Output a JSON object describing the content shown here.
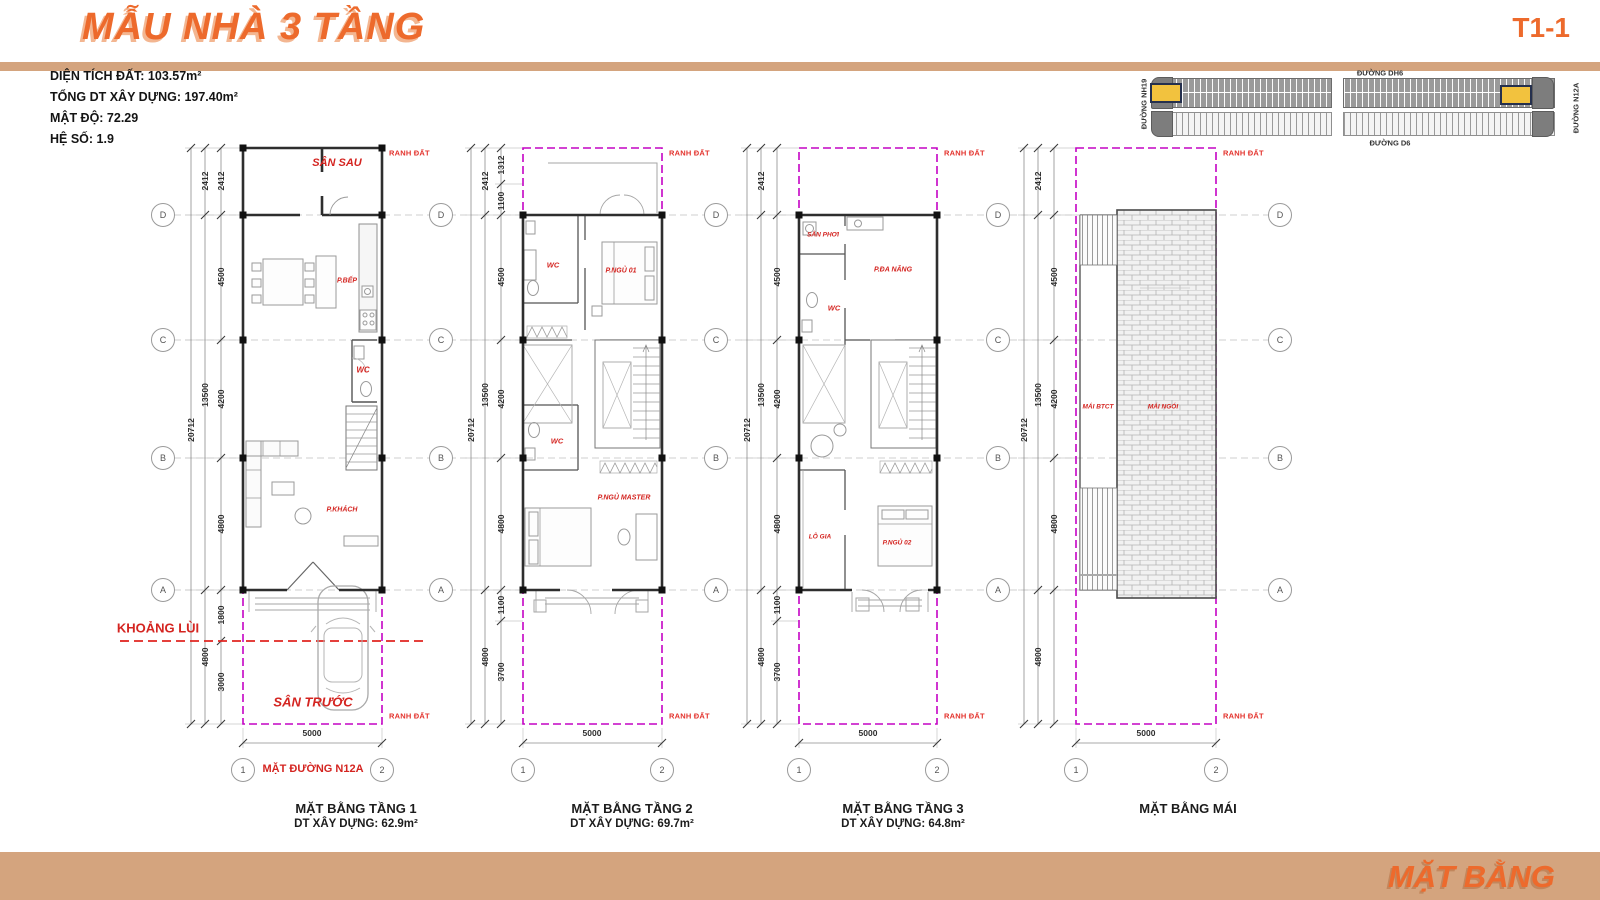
{
  "header": {
    "title": "MẪU NHÀ 3 TẦNG",
    "code": "T1-1",
    "stats": [
      "DIỆN TÍCH ĐẤT: 103.57m²",
      "TỔNG DT XÂY DỰNG: 197.40m²",
      "MẬT ĐỘ: 72.29",
      "HỆ SỐ: 1.9"
    ]
  },
  "site_map": {
    "road_top": "ĐƯỜNG DH6",
    "road_bottom": "ĐƯỜNG D6",
    "road_left": "ĐƯỜNG NH19",
    "road_right": "ĐƯỜNG N12A"
  },
  "grid": {
    "letters": [
      "D",
      "C",
      "B",
      "A"
    ],
    "axes": [
      "1",
      "2"
    ]
  },
  "labels": {
    "boundary": "RANH ĐẤT",
    "setback": "KHOẢNG LÙI",
    "street": "MẶT ĐƯỜNG N12A"
  },
  "plans": [
    {
      "caption": "MẶT BẰNG TẦNG 1",
      "area": "DT XÂY DỰNG: 62.9m²",
      "rooms": {
        "back_yard": "SÂN SAU",
        "kitchen": "P.BẾP",
        "wc": "WC",
        "living": "P.KHÁCH",
        "front_yard": "SÂN TRƯỚC"
      },
      "dims": [
        "2412",
        "2412",
        "4500",
        "13500",
        "4200",
        "20712",
        "4800",
        "1800",
        "4800",
        "3000",
        "5000"
      ]
    },
    {
      "caption": "MẶT BẰNG TẦNG 2",
      "area": "DT XÂY DỰNG: 69.7m²",
      "rooms": {
        "wc1": "WC",
        "bed1": "P.NGỦ 01",
        "wc2": "WC",
        "master": "P.NGỦ MASTER"
      },
      "dims": [
        "2412",
        "1312",
        "1100",
        "4500",
        "13500",
        "4200",
        "20712",
        "4800",
        "1100",
        "4800",
        "3700",
        "5000"
      ]
    },
    {
      "caption": "MẶT BẰNG TẦNG 3",
      "area": "DT XÂY DỰNG: 64.8m²",
      "rooms": {
        "laundry": "SÂN PHƠI",
        "multi": "P.ĐA NĂNG",
        "wc": "WC",
        "loggia": "LÔ GIA",
        "bed2": "P.NGỦ 02"
      },
      "dims": [
        "2412",
        "4500",
        "13500",
        "4200",
        "20712",
        "4800",
        "1100",
        "4800",
        "3700",
        "5000"
      ]
    },
    {
      "caption": "MẶT BẰNG MÁI",
      "area": "",
      "rooms": {
        "concrete": "MÁI BTCT",
        "tile": "MÁI NGÓI"
      },
      "dims": [
        "2412",
        "4500",
        "13500",
        "4200",
        "20712",
        "4800",
        "4800",
        "5000"
      ]
    }
  ],
  "footer": {
    "label": "MẶT BẰNG"
  },
  "colors": {
    "accent": "#ed6a2c",
    "band": "#d4a47e",
    "boundary": "#c403c4",
    "annotation": "#e3312b",
    "highlight": "#f2c23e"
  }
}
